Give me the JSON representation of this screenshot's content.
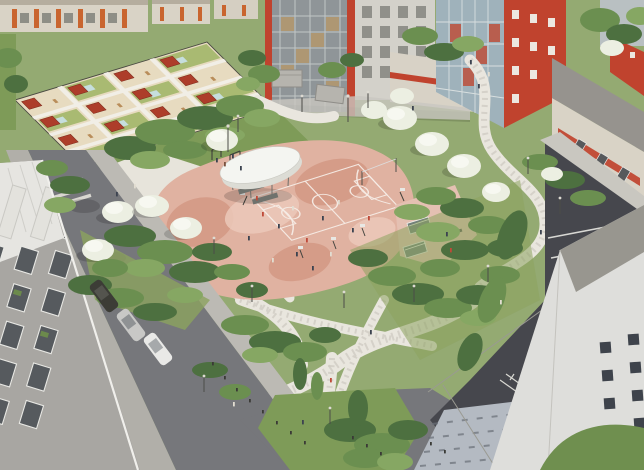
{
  "scene": {
    "type": "aerial-architectural-render",
    "description": "Bird's-eye 3D visualization of a landscaped residential courtyard: a central pink sports/play court with a white oval canopy and basketball markings, a kindergarten play yard with red shade canopies, winding pedestrian paths through dense greenery with flowering trees, an internal street with parked cars, a guest parking lot, a paver plaza and surrounding apartment buildings with red-orange accent facades.",
    "counts": {
      "cars_on_street": 3,
      "cars_in_parking": 3,
      "ping_pong_tables": 2,
      "storage_sheds": 2,
      "red_play_canopies": 12
    },
    "regions": [
      "kindergarten play yard",
      "central sports court",
      "white oval canopy",
      "street workout zone",
      "table tennis area",
      "pedestrian path network",
      "internal street with parallel parking",
      "guest parking lot",
      "paver plaza",
      "apartment building west",
      "residential tower north",
      "tower with red facade north-east",
      "podium building east",
      "public building south-east",
      "green buffer with flowering trees"
    ],
    "palette": {
      "park_base": "#94aa72",
      "lawn": "#7e9b58",
      "shrub_dark": "#4d7040",
      "shrub_mid": "#6b8f50",
      "shrub_light": "#86a763",
      "bloom_white": "#ecefe2",
      "path_light": "#e9e6de",
      "plaza_light": "#e7e4db",
      "court_pink": "#e0b2a1",
      "court_pink_deep": "#d49a86",
      "court_line": "#f6ece6",
      "canopy_white": "#f4f5f1",
      "yard_sand": "#e7dbc0",
      "yard_cell_green": "#a9ba72",
      "yard_cell_teal": "#c6dedd",
      "yard_path": "#f1eee6",
      "canopy_red": "#ad3d2a",
      "road_gray": "#76777b",
      "asphalt_dark": "#46474d",
      "sidewalk": "#bcbab4",
      "paver_blue": "#b4bac2",
      "beige_wall": "#d9d3c6",
      "orange_accent": "#c9652f",
      "red_facade": "#c0432e",
      "tower_glass": "#9fb2bb",
      "tower_gray": "#d3d1ca",
      "glass_amber": "#c99a55",
      "roof_gray": "#96938e",
      "white_building": "#dededb",
      "window_dark": "#3e434b",
      "facade_left": "#a8a6a2",
      "car_dark": "#3c3c36",
      "car_silver": "#c8c8c6",
      "car_white": "#e9e9e7",
      "fence_dark": "#4a4a42"
    }
  }
}
